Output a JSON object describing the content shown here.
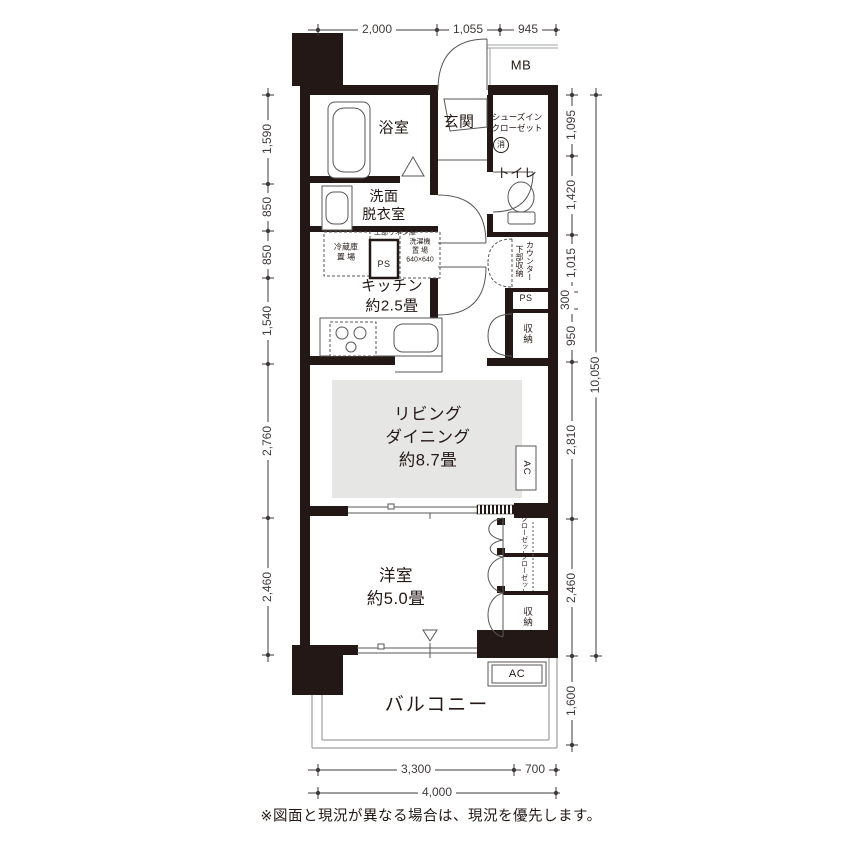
{
  "note": "※図面と現況が異なる場合は、現況を優先します。",
  "dims": {
    "top": [
      "2,000",
      "1,055",
      "945"
    ],
    "bottom": [
      "3,300",
      "700"
    ],
    "bottom_total": "4,000",
    "left": [
      "1,590",
      "850",
      "850",
      "1,540",
      "2,760",
      "2,460"
    ],
    "right": [
      "1,095",
      "1,420",
      "1,015",
      "300",
      "950",
      "2,810",
      "2,460",
      "1,600"
    ],
    "right_total": "10,050"
  },
  "rooms": {
    "mb": "MB",
    "bath": "浴室",
    "entrance": "玄関",
    "sic": "シューズイン\nクローゼット",
    "extinguisher": "消",
    "toilet": "トイレ",
    "washroom": "洗面\n脱衣室",
    "linen": "上部リネン庫",
    "fridge": "冷蔵庫\n置 場",
    "ps1": "PS",
    "laundry": "洗濯機\n置 場\n640×640",
    "kitchen": "キッチン\n約2.5畳",
    "counter_storage": "カウンター下部収納",
    "ps2": "PS",
    "storage_mid": "収納",
    "living": "リビング\nダイニング\n約8.7畳",
    "ac1": "AC",
    "bedroom": "洋室\n約5.0畳",
    "closet1": "クローゼット",
    "closet2": "クローゼット",
    "storage_bedroom": "収納",
    "balcony": "バルコニー",
    "ac2": "AC"
  },
  "colors": {
    "wall": "#231815",
    "living_fill": "#e6e6e4",
    "line": "#595757",
    "dimension": "#3e3a39",
    "balcony_line": "#9fa0a0"
  }
}
